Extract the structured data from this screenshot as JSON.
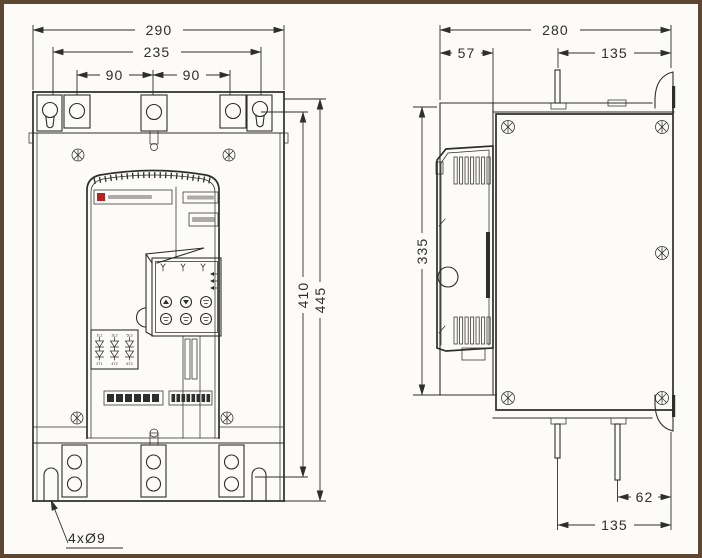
{
  "title": "soft starter outline and mounting dimension drawing",
  "front": {
    "dims": {
      "overall_width": "290",
      "mounting_width": "235",
      "hole_pitch_left": "90",
      "hole_pitch_right": "90",
      "mounting_height": "410",
      "overall_height": "445",
      "slot_note": "4xØ9"
    },
    "scr_top": [
      "1L1",
      "3L2",
      "5L3"
    ],
    "scr_bot": [
      "2T1",
      "4T2",
      "6T3"
    ]
  },
  "side": {
    "dims": {
      "overall_depth": "280",
      "front_depth": "57",
      "top_pin_offset": "135",
      "body_height": "335",
      "bottom_pin_inner": "62",
      "bottom_pin_outer": "135"
    }
  },
  "colors": {
    "line": "#2e2e2e",
    "frame": "#5d4733",
    "red": "#b3231f",
    "paper": "#fcfbf7"
  }
}
